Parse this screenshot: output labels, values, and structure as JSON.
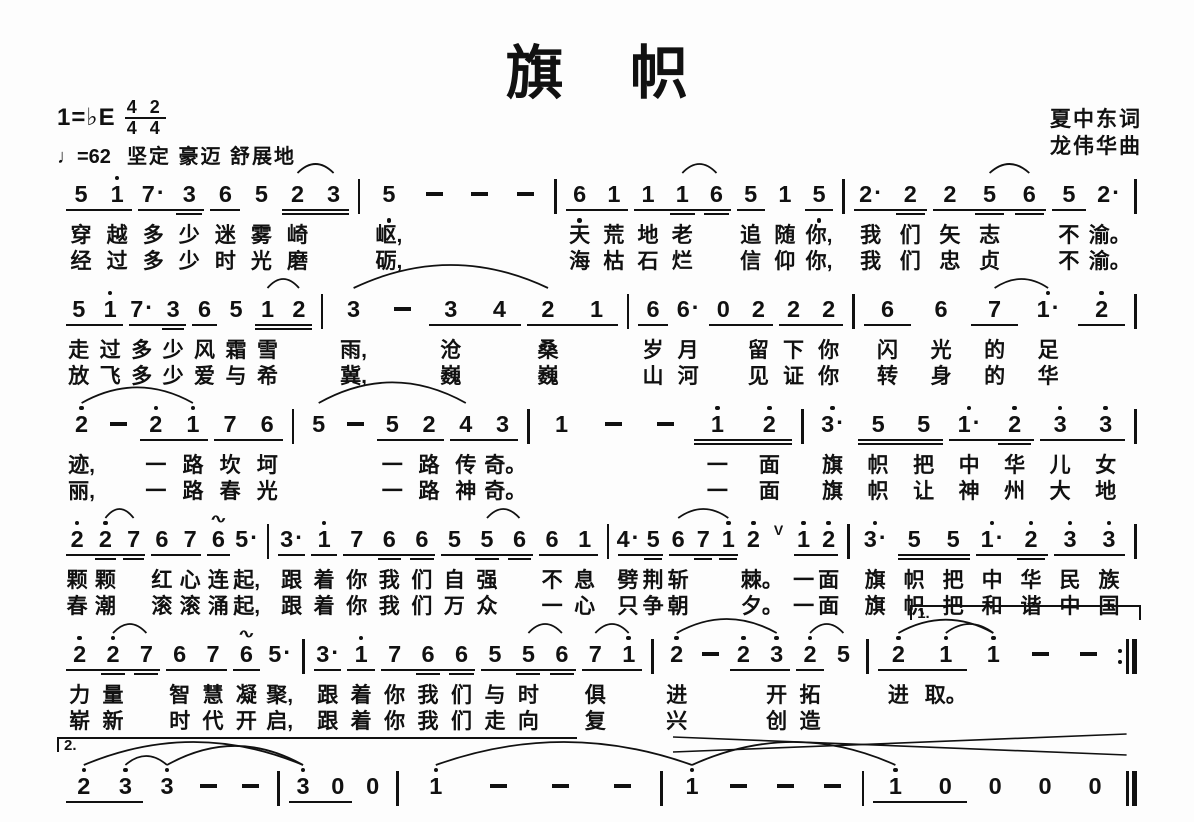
{
  "page": {
    "bg": "#fdfdfd",
    "ink": "#111111"
  },
  "header": {
    "title": "旗 帜",
    "key": "1=♭E",
    "time_top": "4 2",
    "time_bottom": "4 4",
    "tempo": "♩=62",
    "expression": "坚定 豪迈 舒展地",
    "lyricist": "夏中东词",
    "composer": "龙伟华曲"
  },
  "score": {
    "notation": "jianpu",
    "systems": [
      {
        "arcs": [
          {
            "a": 6,
            "b": 7
          },
          {
            "a": 15,
            "b": 16
          },
          {
            "a": 23,
            "b": 24
          }
        ],
        "measures": [
          {
            "w": 301,
            "g": [
              {
                "u": 1,
                "t": "5 1'"
              },
              {
                "u": 1,
                "t": "7. 3="
              },
              {
                "u": 1,
                "t": "6"
              },
              {
                "u": 0,
                "t": "5"
              },
              {
                "u": 2,
                "t": "2 3"
              }
            ],
            "l1": [
              "穿",
              "越",
              "多",
              "少",
              "迷",
              "雾",
              "崎",
              ""
            ],
            "l2": [
              "经",
              "过",
              "多",
              "少",
              "时",
              "光",
              "磨",
              ""
            ]
          },
          {
            "w": 194,
            "g": [
              {
                "u": 0,
                "t": "5, - - -"
              }
            ],
            "l1": [
              "岖,",
              "",
              "",
              ""
            ],
            "l2": [
              "砺,",
              "",
              "",
              ""
            ]
          },
          {
            "w": 286,
            "g": [
              {
                "u": 1,
                "t": "6, 1"
              },
              {
                "u": 1,
                "t": "1 1= 6="
              },
              {
                "u": 1,
                "t": "5"
              },
              {
                "u": 0,
                "t": "1"
              },
              {
                "u": 1,
                "t": "5,"
              }
            ],
            "l1": [
              "天",
              "荒",
              "地",
              "老",
              "",
              "追",
              "随",
              "你,"
            ],
            "l2": [
              "海",
              "枯",
              "石",
              "烂",
              "",
              "信",
              "仰",
              "你,"
            ]
          },
          {
            "w": 290,
            "g": [
              {
                "u": 1,
                "t": "2. 2="
              },
              {
                "u": 1,
                "t": "2 5= 6="
              },
              {
                "u": 1,
                "t": "5"
              },
              {
                "u": 0,
                "t": "2."
              }
            ],
            "l1": [
              "我",
              "们",
              "矢",
              "志",
              "",
              "不",
              "渝。"
            ],
            "l2": [
              "我",
              "们",
              "忠",
              "贞",
              "",
              "不",
              "渝。"
            ]
          }
        ]
      },
      {
        "arcs": [
          {
            "a": 6,
            "b": 7
          },
          {
            "a": 8,
            "b": 12
          },
          {
            "a": 22,
            "b": 23
          }
        ],
        "measures": [
          {
            "w": 264,
            "g": [
              {
                "u": 1,
                "t": "5 1'"
              },
              {
                "u": 1,
                "t": "7. 3="
              },
              {
                "u": 1,
                "t": "6"
              },
              {
                "u": 0,
                "t": "5"
              },
              {
                "u": 2,
                "t": "1 2"
              }
            ],
            "l1": [
              "走",
              "过",
              "多",
              "少",
              "风",
              "霜",
              "雪",
              ""
            ],
            "l2": [
              "放",
              "飞",
              "多",
              "少",
              "爱",
              "与",
              "希",
              ""
            ]
          },
          {
            "w": 304,
            "g": [
              {
                "u": 0,
                "t": "3 -"
              },
              {
                "u": 1,
                "t": "3 4"
              },
              {
                "u": 1,
                "t": "2 1"
              }
            ],
            "l1": [
              "雨,",
              "",
              "沧",
              "",
              "桑",
              ""
            ],
            "l2": [
              "冀,",
              "",
              "巍",
              "",
              "巍",
              ""
            ]
          },
          {
            "w": 223,
            "g": [
              {
                "u": 1,
                "t": "6"
              },
              {
                "u": 0,
                "t": "6."
              },
              {
                "u": 1,
                "t": "0 2"
              },
              {
                "u": 1,
                "t": "2 2"
              }
            ],
            "l1": [
              "岁",
              "月",
              "",
              "留",
              "下",
              "你"
            ],
            "l2": [
              "山",
              "河",
              "",
              "见",
              "证",
              "你"
            ]
          },
          {
            "w": 280,
            "g": [
              {
                "u": 1,
                "t": "6"
              },
              {
                "u": 0,
                "t": "6"
              },
              {
                "u": 1,
                "t": "7"
              },
              {
                "u": 0,
                "t": "1'."
              },
              {
                "u": 1,
                "t": "2'"
              }
            ],
            "l1": [
              "闪",
              "光",
              "的",
              "足",
              ""
            ],
            "l2": [
              "转",
              "身",
              "的",
              "华",
              ""
            ]
          }
        ]
      },
      {
        "arcs": [
          {
            "a": 0,
            "b": 3
          },
          {
            "a": 6,
            "b": 10
          }
        ],
        "measures": [
          {
            "w": 235,
            "g": [
              {
                "u": 0,
                "t": "2' -"
              },
              {
                "u": 1,
                "t": "2' 1'"
              },
              {
                "u": 1,
                "t": "7 6"
              }
            ],
            "l1": [
              "迹,",
              "",
              "一",
              "路",
              "坎",
              "坷"
            ],
            "l2": [
              "丽,",
              "",
              "一",
              "路",
              "春",
              "光"
            ]
          },
          {
            "w": 233,
            "g": [
              {
                "u": 0,
                "t": "5 -"
              },
              {
                "u": 1,
                "t": "5 2"
              },
              {
                "u": 1,
                "t": "4 3"
              }
            ],
            "l1": [
              "",
              "",
              "一",
              "路",
              "传",
              "奇。"
            ],
            "l2": [
              "",
              "",
              "一",
              "路",
              "神",
              "奇。"
            ]
          },
          {
            "w": 272,
            "g": [
              {
                "u": 0,
                "t": "1 - -"
              },
              {
                "u": 2,
                "t": "1' 2'"
              }
            ],
            "l1": [
              "",
              "",
              "",
              "一",
              "面"
            ],
            "l2": [
              "",
              "",
              "",
              "一",
              "面"
            ]
          },
          {
            "w": 331,
            "g": [
              {
                "u": 0,
                "t": "3'."
              },
              {
                "u": 2,
                "t": "5 5"
              },
              {
                "u": 1,
                "t": "1'. 2'="
              },
              {
                "u": 1,
                "t": "3' 3'"
              }
            ],
            "l1": [
              "旗",
              "帜",
              "把",
              "中",
              "华",
              "儿",
              "女"
            ],
            "l2": [
              "旗",
              "帜",
              "让",
              "神",
              "州",
              "大",
              "地"
            ]
          }
        ]
      },
      {
        "arcs": [
          {
            "a": 1,
            "b": 2
          },
          {
            "a": 13,
            "b": 14
          },
          {
            "a": 19,
            "b": 21
          }
        ],
        "measures": [
          {
            "w": 210,
            "g": [
              {
                "u": 1,
                "t": "2' 2'= 7="
              },
              {
                "u": 1,
                "t": "6 7"
              },
              {
                "u": 1,
                "t": "6~"
              },
              {
                "u": 0,
                "t": "5."
              }
            ],
            "l1": [
              "颗",
              "颗",
              "",
              "红",
              "心",
              "连",
              "起,"
            ],
            "l2": [
              "春",
              "潮",
              "",
              "滚",
              "滚",
              "涌",
              "起,"
            ]
          },
          {
            "w": 338,
            "g": [
              {
                "u": 1,
                "t": "3."
              },
              {
                "u": 1,
                "t": "1'"
              },
              {
                "u": 1,
                "t": "7 6= 6="
              },
              {
                "u": 1,
                "t": "5 5= 6="
              },
              {
                "u": 1,
                "t": "6 1"
              }
            ],
            "l1": [
              "跟",
              "着",
              "你",
              "我",
              "们",
              "自",
              "强",
              "",
              "不",
              "息"
            ],
            "l2": [
              "跟",
              "着",
              "你",
              "我",
              "们",
              "万",
              "众",
              "",
              "一",
              "心"
            ]
          },
          {
            "w": 238,
            "g": [
              {
                "u": 1,
                "t": "4. 5="
              },
              {
                "u": 1,
                "t": "6 7= 1'="
              },
              {
                "u": 0,
                "t": "2'"
              },
              {
                "u": 0,
                "t": "v"
              },
              {
                "u": 1,
                "t": "1' 2'"
              }
            ],
            "l1": [
              "劈",
              "荆",
              "斩",
              "",
              "",
              "棘。",
              "",
              "一",
              "面"
            ],
            "l2": [
              "只",
              "争",
              "朝",
              "",
              "",
              "夕。",
              "",
              "一",
              "面"
            ]
          },
          {
            "w": 285,
            "g": [
              {
                "u": 0,
                "t": "3'."
              },
              {
                "u": 2,
                "t": "5 5"
              },
              {
                "u": 1,
                "t": "1'. 2'="
              },
              {
                "u": 1,
                "t": "3' 3'"
              }
            ],
            "l1": [
              "旗",
              "帜",
              "把",
              "中",
              "华",
              "民",
              "族"
            ],
            "l2": [
              "旗",
              "帜",
              "把",
              "和",
              "谐",
              "中",
              "国"
            ]
          }
        ]
      },
      {
        "arcs": [
          {
            "a": 1,
            "b": 2
          },
          {
            "a": 13,
            "b": 14
          },
          {
            "a": 15,
            "b": 16
          },
          {
            "a": 17,
            "b": 20
          },
          {
            "a": 21,
            "b": 22
          },
          {
            "a": 23,
            "b": 25
          },
          {
            "a": 24,
            "b": 25
          }
        ],
        "volta": {
          "label": "1.",
          "left": 79,
          "width": 21,
          "right_tick": true
        },
        "measures": [
          {
            "w": 250,
            "g": [
              {
                "u": 1,
                "t": "2' 2'= 7="
              },
              {
                "u": 1,
                "t": "6 7"
              },
              {
                "u": 1,
                "t": "6~"
              },
              {
                "u": 0,
                "t": "5."
              }
            ],
            "l1": [
              "力",
              "量",
              "",
              "智",
              "慧",
              "凝",
              "聚,"
            ],
            "l2": [
              "崭",
              "新",
              "",
              "时",
              "代",
              "开",
              "启,"
            ]
          },
          {
            "w": 353,
            "g": [
              {
                "u": 1,
                "t": "3."
              },
              {
                "u": 1,
                "t": "1'"
              },
              {
                "u": 1,
                "t": "7 6= 6="
              },
              {
                "u": 1,
                "t": "5 5= 6="
              },
              {
                "u": 1,
                "t": "7 1'"
              }
            ],
            "l1": [
              "跟",
              "着",
              "你",
              "我",
              "们",
              "与",
              "时",
              "",
              "俱",
              ""
            ],
            "l2": [
              "跟",
              "着",
              "你",
              "我",
              "们",
              "走",
              "向",
              "",
              "复",
              ""
            ]
          },
          {
            "w": 216,
            "g": [
              {
                "u": 0,
                "t": "2' -"
              },
              {
                "u": 1,
                "t": "2' 3'"
              },
              {
                "u": 1,
                "t": "2'"
              },
              {
                "u": 0,
                "t": "5"
              }
            ],
            "l1": [
              "进",
              "",
              "",
              "开",
              "拓",
              ""
            ],
            "l2": [
              "兴",
              "",
              "",
              "创",
              "造",
              ""
            ]
          },
          {
            "w": 254,
            "bar": ":|",
            "g": [
              {
                "u": 1,
                "t": "2' 1'"
              },
              {
                "u": 0,
                "t": "1' - -"
              }
            ],
            "l1": [
              "进",
              "取。",
              "",
              "",
              ""
            ],
            "l2": [
              "",
              "",
              "",
              "",
              ""
            ]
          }
        ]
      },
      {
        "arcs": [
          {
            "a": 0,
            "b": 5
          },
          {
            "a": 1,
            "b": 2
          },
          {
            "a": 2,
            "b": 5
          },
          {
            "a": 8,
            "b": 12
          },
          {
            "a": 12,
            "b": 16
          }
        ],
        "volta": {
          "label": "2.",
          "left": 0,
          "width": 48,
          "right_tick": false
        },
        "hairpin": {
          "left": 57,
          "width": 42
        },
        "spaced": true,
        "measures": [
          {
            "w": 223,
            "g": [
              {
                "u": 1,
                "t": "2' 3'"
              },
              {
                "u": 0,
                "t": "3' - -"
              }
            ]
          },
          {
            "w": 118,
            "g": [
              {
                "u": 1,
                "t": "3' 0"
              },
              {
                "u": 0,
                "t": "0"
              }
            ]
          },
          {
            "w": 265,
            "g": [
              {
                "u": 0,
                "t": "1' - - -"
              }
            ]
          },
          {
            "w": 202,
            "g": [
              {
                "u": 0,
                "t": "1' - - -"
              }
            ]
          },
          {
            "w": 265,
            "bar": "||",
            "g": [
              {
                "u": 1,
                "t": "1' 0"
              },
              {
                "u": 0,
                "t": "0 0 0"
              }
            ]
          }
        ]
      }
    ]
  }
}
